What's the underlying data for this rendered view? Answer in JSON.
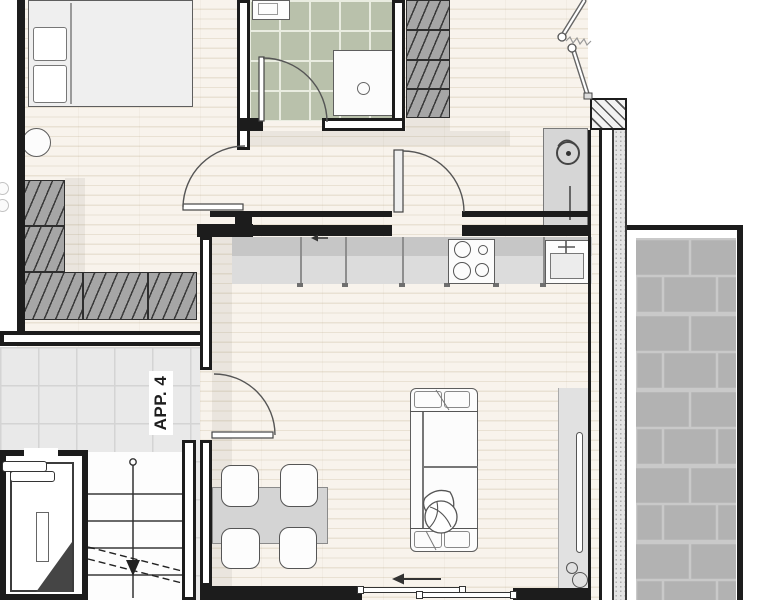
{
  "unit_label": "APP. 4",
  "colors": {
    "wall": "#1c1c1c",
    "wood_floor": "#f8f3ec",
    "plank_line": "#e9e1d3",
    "bathroom_tile": "#b9c1ab",
    "bathroom_grout": "#e9ece0",
    "landing_tile": "#e9e9e9",
    "landing_grout": "#d4d4d4",
    "balcony_tile": "#b2b2b2",
    "balcony_grout": "#c9c9c9",
    "counter_base": "#dcdcdc",
    "counter_top": "#c6c6c6",
    "furniture_outline": "#5e5e5e",
    "wardrobe_fill": "#a6a6a6",
    "shadow": "rgba(60,55,45,0.07)"
  }
}
